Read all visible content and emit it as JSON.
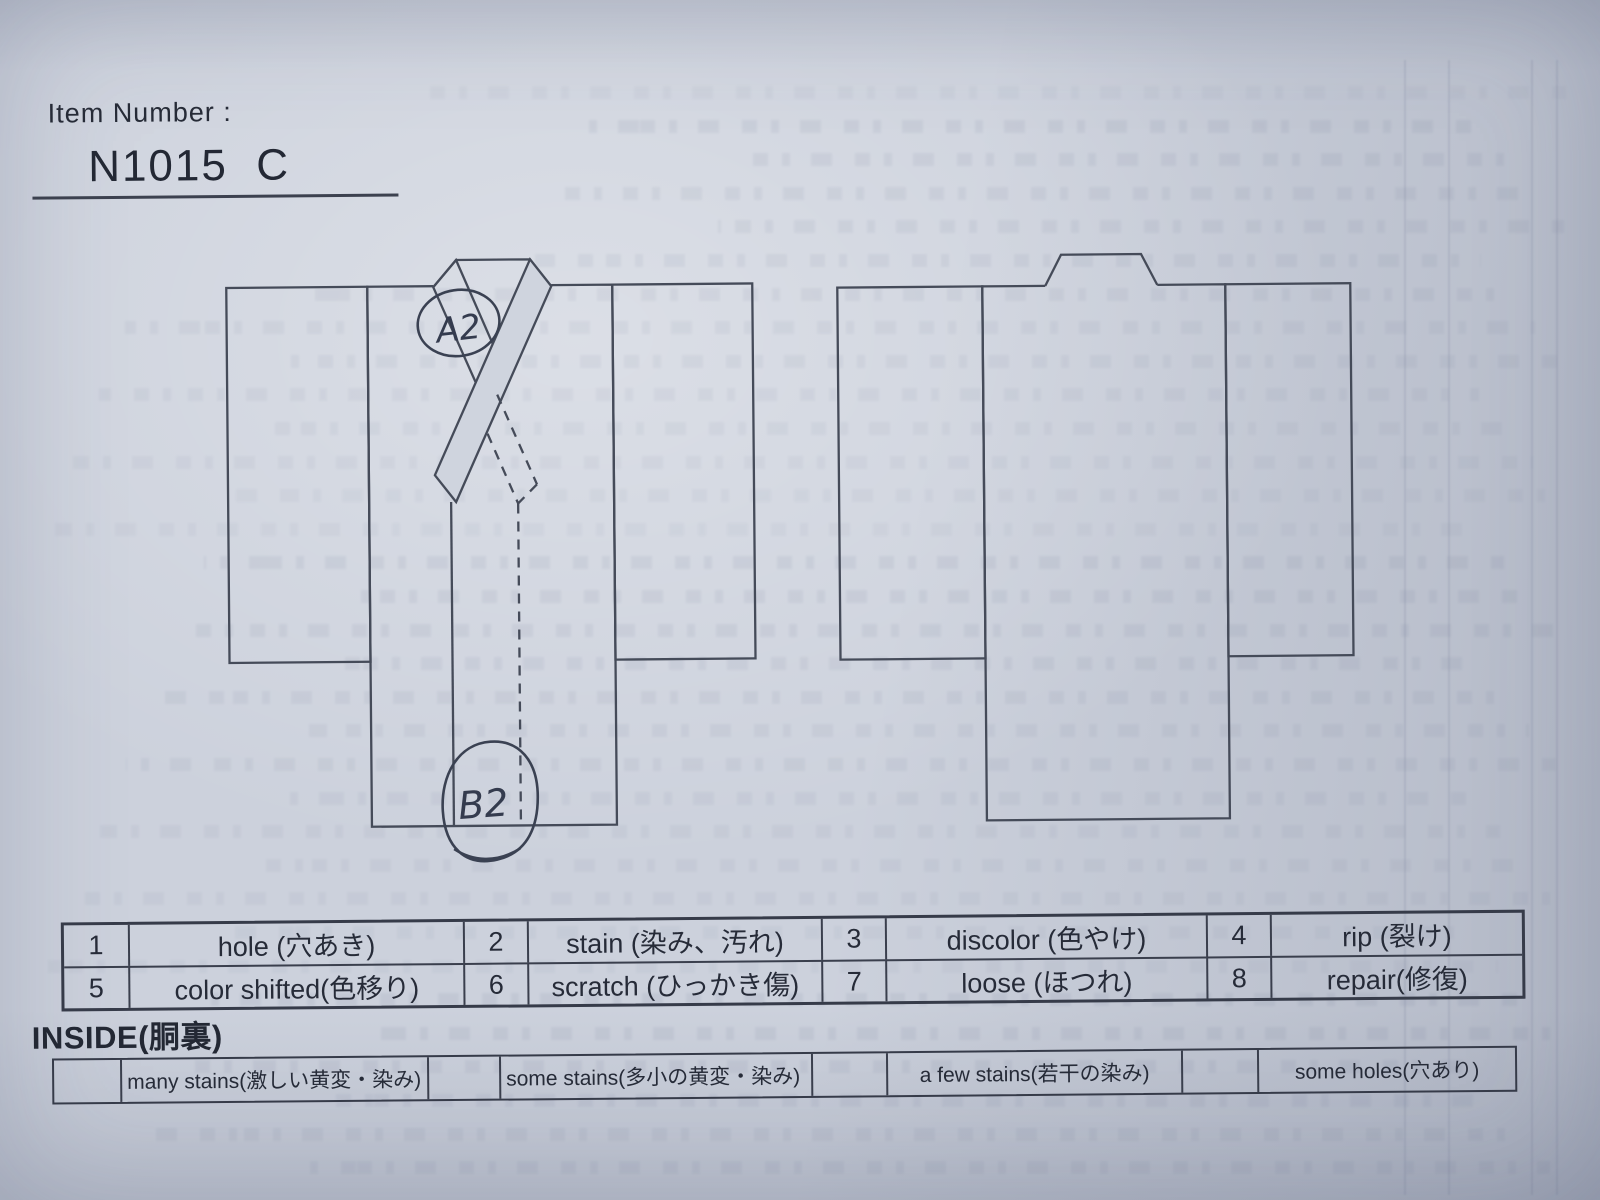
{
  "document": {
    "item_number_label": "Item Number :",
    "item_number_value": "N1015  C"
  },
  "diagram": {
    "annotations": {
      "collar_mark": "A2",
      "hem_mark": "B2"
    }
  },
  "defect_legend": {
    "items": [
      {
        "code": "1",
        "label": "hole (穴あき)"
      },
      {
        "code": "2",
        "label": "stain (染み、汚れ)"
      },
      {
        "code": "3",
        "label": "discolor (色やけ)"
      },
      {
        "code": "4",
        "label": "rip (裂け)"
      },
      {
        "code": "5",
        "label": "color shifted(色移り)"
      },
      {
        "code": "6",
        "label": "scratch (ひっかき傷)"
      },
      {
        "code": "7",
        "label": "loose (ほつれ)"
      },
      {
        "code": "8",
        "label": "repair(修復)"
      }
    ]
  },
  "inside_section": {
    "title": "INSIDE(胴裏)",
    "options": [
      {
        "label": "many stains(激しい黄変・染み)"
      },
      {
        "label": "some stains(多小の黄変・染み)"
      },
      {
        "label": "a few stains(若干の染み)"
      },
      {
        "label": "some holes(穴あり)"
      }
    ]
  },
  "colors": {
    "paper": "#ccd1dc",
    "ink": "#262b38",
    "outline": "#454b59",
    "handwriting": "#3a4152"
  }
}
